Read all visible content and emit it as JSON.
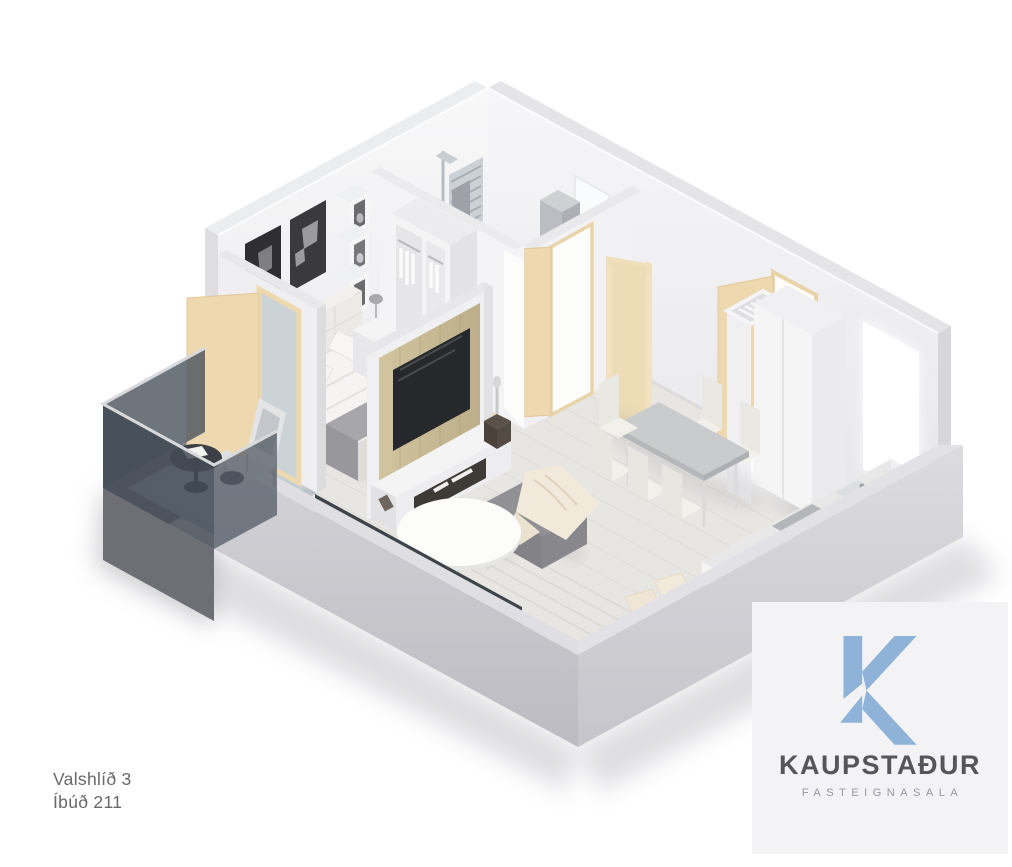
{
  "annotation": {
    "address": "Valshlíð 3",
    "unit": "Íbúð 211",
    "text_color": "#68686a"
  },
  "logo": {
    "company": "KAUPSTAÐUR",
    "tagline": "FASTEIGNASALA",
    "mark_color": "#8fb2d8",
    "company_color": "#565658",
    "tagline_color": "#97979a",
    "panel_color": "#f3f3f5"
  },
  "scene": {
    "view": "isometric-3d-dollhouse-floor-plan",
    "rooms": [
      {
        "name": "bedroom",
        "furniture": [
          "double-bed",
          "tufted-headboard",
          "two-art-frames",
          "wall-cube-shelves",
          "wardrobe-with-clothes",
          "nightstands-with-lamps"
        ]
      },
      {
        "name": "bathroom",
        "furniture": [
          "walk-in-shower",
          "towel-radiator",
          "wall-hung-toilet",
          "vanity-sink-mirror",
          "washing-machine",
          "tall-gray-cabinet"
        ]
      },
      {
        "name": "hallway",
        "furniture": [
          "open-beige-interior-doors",
          "entry-door-open"
        ]
      },
      {
        "name": "living-room",
        "furniture": [
          "gray-corner-sofa",
          "cream-pillows",
          "ottoman-with-throw",
          "round-white-coffee-table",
          "area-rug",
          "tv-on-wood-panel",
          "media-console"
        ]
      },
      {
        "name": "kitchen-dining",
        "furniture": [
          "kitchen-counter-run",
          "cooktop",
          "sink",
          "dining-table-concrete-top",
          "six-white-chairs",
          "white-closet",
          "open-hanger-rack",
          "window-glow"
        ]
      },
      {
        "name": "balcony",
        "furniture": [
          "lounge-chair",
          "round-dark-side-table",
          "dark-glass-railing"
        ]
      }
    ],
    "palette": {
      "wall_inner": "#f3f3f5",
      "wall_outer": "#cfced3",
      "floor_wood": "#e7e5e1",
      "bath_floor": "#d0d3d5",
      "sofa_gray": "#919195",
      "pillow_cream": "#f1e9da",
      "door_beige": "#eed8b0",
      "balcony_glass": "#4a525c",
      "tv_panel_wood": "#c8ba94"
    }
  }
}
